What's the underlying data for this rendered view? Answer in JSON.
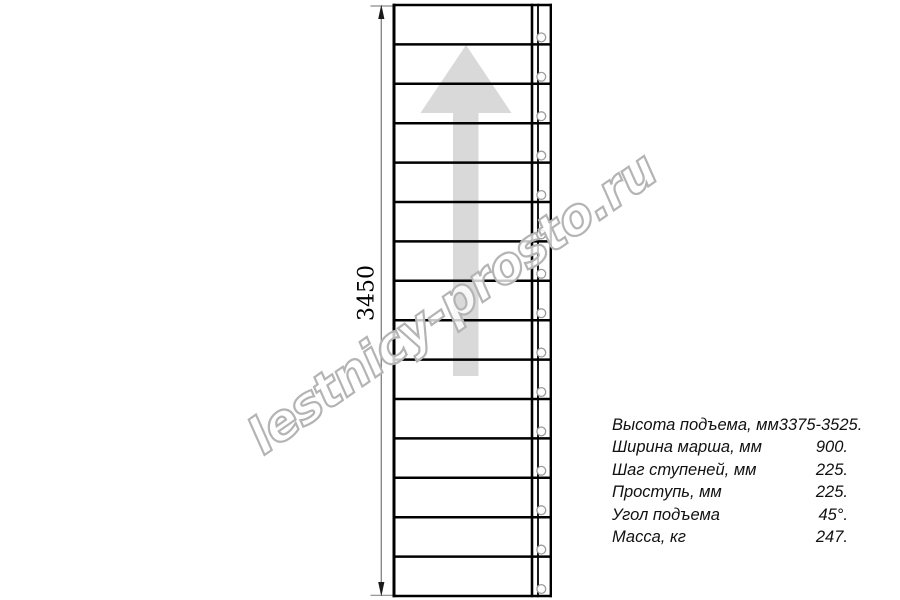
{
  "page": {
    "background": "#ffffff"
  },
  "drawing": {
    "dimension_label": "3450",
    "steps_count": 15,
    "line_color": "#000000",
    "arrow_color": "#d9d9d9",
    "fastener_color": "#9c9c9c",
    "dimension_color": "#8a8a8a"
  },
  "watermark": {
    "text": "lestnicy-prosto.ru",
    "outline_color": "#b4b4b4"
  },
  "specs": {
    "rows": [
      {
        "label": "Высота подъема, мм",
        "value": "3375-3525."
      },
      {
        "label": "Ширина марша, мм",
        "value": "900."
      },
      {
        "label": "Шаг ступеней, мм",
        "value": "225."
      },
      {
        "label": "Проступь, мм",
        "value": "225."
      },
      {
        "label": "Угол подъема",
        "value": "45°."
      },
      {
        "label": "Масса, кг",
        "value": "247."
      }
    ]
  }
}
